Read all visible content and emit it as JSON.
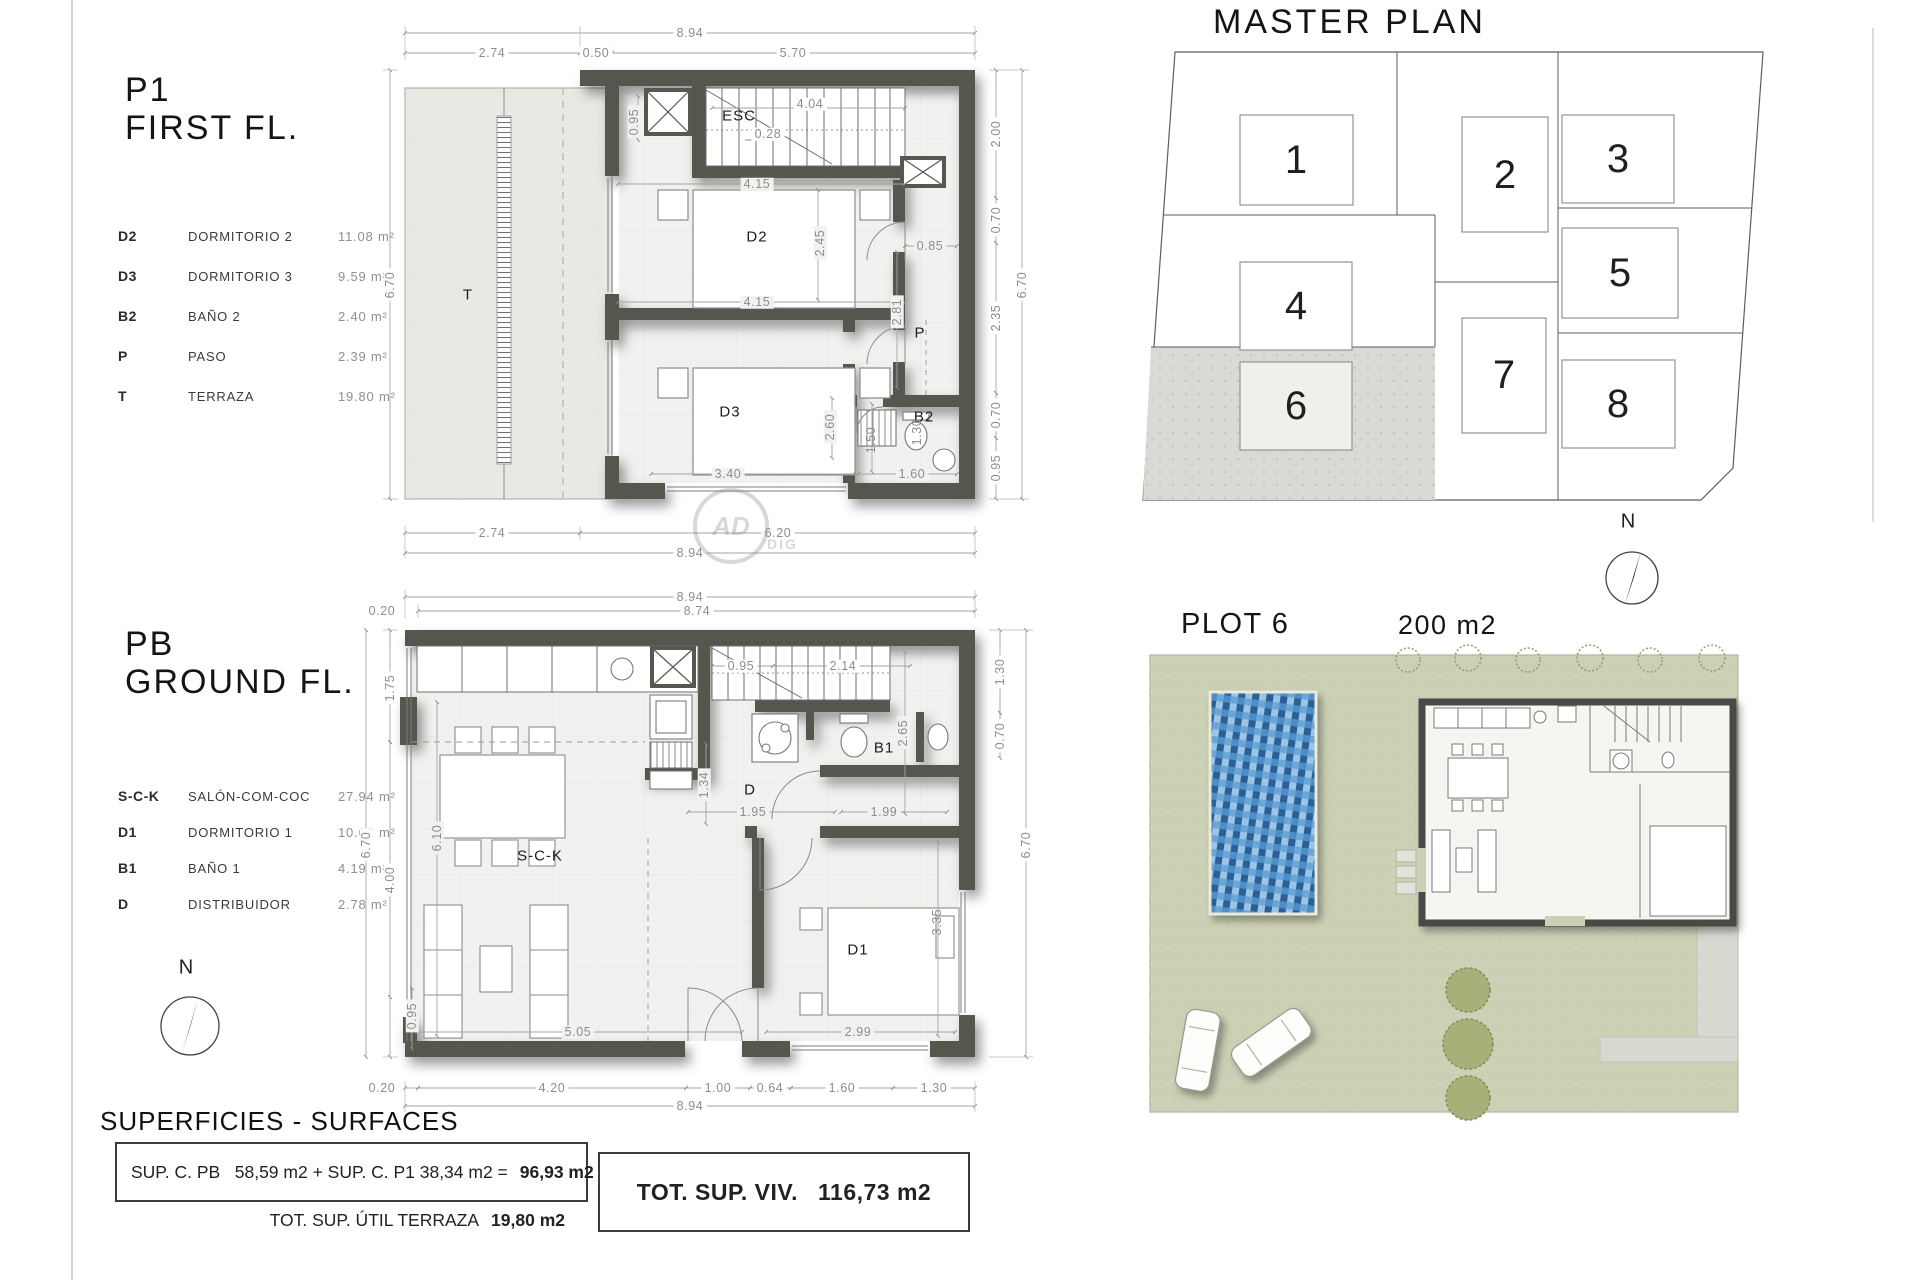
{
  "sheet": {
    "north": "N",
    "watermark_main": "AD",
    "watermark_sub": "DIG"
  },
  "f1": {
    "code": "P1",
    "title": "FIRST FL.",
    "legend": [
      {
        "code": "D2",
        "name": "DORMITORIO 2",
        "area": "11.08 m²"
      },
      {
        "code": "D3",
        "name": "DORMITORIO 3",
        "area": "9.59 m²"
      },
      {
        "code": "B2",
        "name": "BAÑO 2",
        "area": "2.40 m²"
      },
      {
        "code": "P",
        "name": "PASO",
        "area": "2.39 m²"
      },
      {
        "code": "T",
        "name": "TERRAZA",
        "area": "19.80 m²"
      }
    ],
    "rooms": {
      "t": "T",
      "esc": "ESC",
      "d2": "D2",
      "d3": "D3",
      "p": "P",
      "b2": "B2"
    },
    "dims": {
      "top_total": "8.94",
      "top_a": "2.74",
      "top_b": "0.50",
      "top_c": "5.70",
      "left_total": "6.70",
      "stair_w": "4.04",
      "tread": "0.28",
      "shaft": "0.95",
      "d2_top": "4.15",
      "d2_h": "2.45",
      "d2_bottom": "4.15",
      "hall_w": "0.85",
      "hall_h": "2.81",
      "d3_w": "3.40",
      "bath_corr": "2.60",
      "bath_a": "1.50",
      "bath_b": "1.30",
      "bath_w": "1.60",
      "right_a": "2.00",
      "right_b": "0.70",
      "right_c": "2.35",
      "right_d": "0.70",
      "right_e": "0.95",
      "right_total": "6.70",
      "bottom_a": "2.74",
      "bottom_b": "6.20",
      "bottom_total": "8.94"
    }
  },
  "pb": {
    "code": "PB",
    "title": "GROUND FL.",
    "legend": [
      {
        "code": "S-C-K",
        "name": "SALÓN-COM-COC",
        "area": "27.94 m²"
      },
      {
        "code": "D1",
        "name": "DORMITORIO 1",
        "area": "10.02 m²"
      },
      {
        "code": "B1",
        "name": "BAÑO 1",
        "area": "4.19 m²"
      },
      {
        "code": "D",
        "name": "DISTRIBUIDOR",
        "area": "2.78 m²"
      }
    ],
    "rooms": {
      "sck": "S-C-K",
      "d": "D",
      "b1": "B1",
      "d1": "D1"
    },
    "dims": {
      "top_total": "8.94",
      "top_inner": "8.74",
      "top_offset": "0.20",
      "left_a": "1.75",
      "left_b": "4.00",
      "left_c": "0.95",
      "left_total": "6.70",
      "stair_a": "0.95",
      "stair_b": "2.14",
      "kitchen_h": "1.34",
      "hall_w": "1.95",
      "bath_h": "2.65",
      "bath_w": "1.99",
      "living_h": "6.10",
      "living_w": "5.05",
      "d1_h": "3.35",
      "d1_w": "2.99",
      "right_a": "1.30",
      "right_b": "0.70",
      "right_total": "6.70",
      "bottom_off": "0.20",
      "bottom_a": "4.20",
      "bottom_b": "1.00",
      "bottom_c": "0.64",
      "bottom_d": "1.60",
      "bottom_e": "1.30",
      "bottom_total": "8.94"
    }
  },
  "master": {
    "title": "MASTER PLAN",
    "plots": [
      {
        "n": "1"
      },
      {
        "n": "2"
      },
      {
        "n": "3"
      },
      {
        "n": "4"
      },
      {
        "n": "5"
      },
      {
        "n": "6"
      },
      {
        "n": "7"
      },
      {
        "n": "8"
      }
    ]
  },
  "plot6": {
    "title": "PLOT 6",
    "area": "200 m2"
  },
  "surfaces": {
    "heading": "SUPERFICIES - SURFACES",
    "formula": "SUP. C. PB   58,59 m2 + SUP. C. P1 38,34 m2 =",
    "formula_result": "96,93 m2",
    "terrace_label": "TOT. SUP. ÚTIL TERRAZA",
    "terrace_value": "19,80 m2",
    "total_label": "TOT. SUP. VIV.",
    "total_value": "116,73 m2"
  }
}
